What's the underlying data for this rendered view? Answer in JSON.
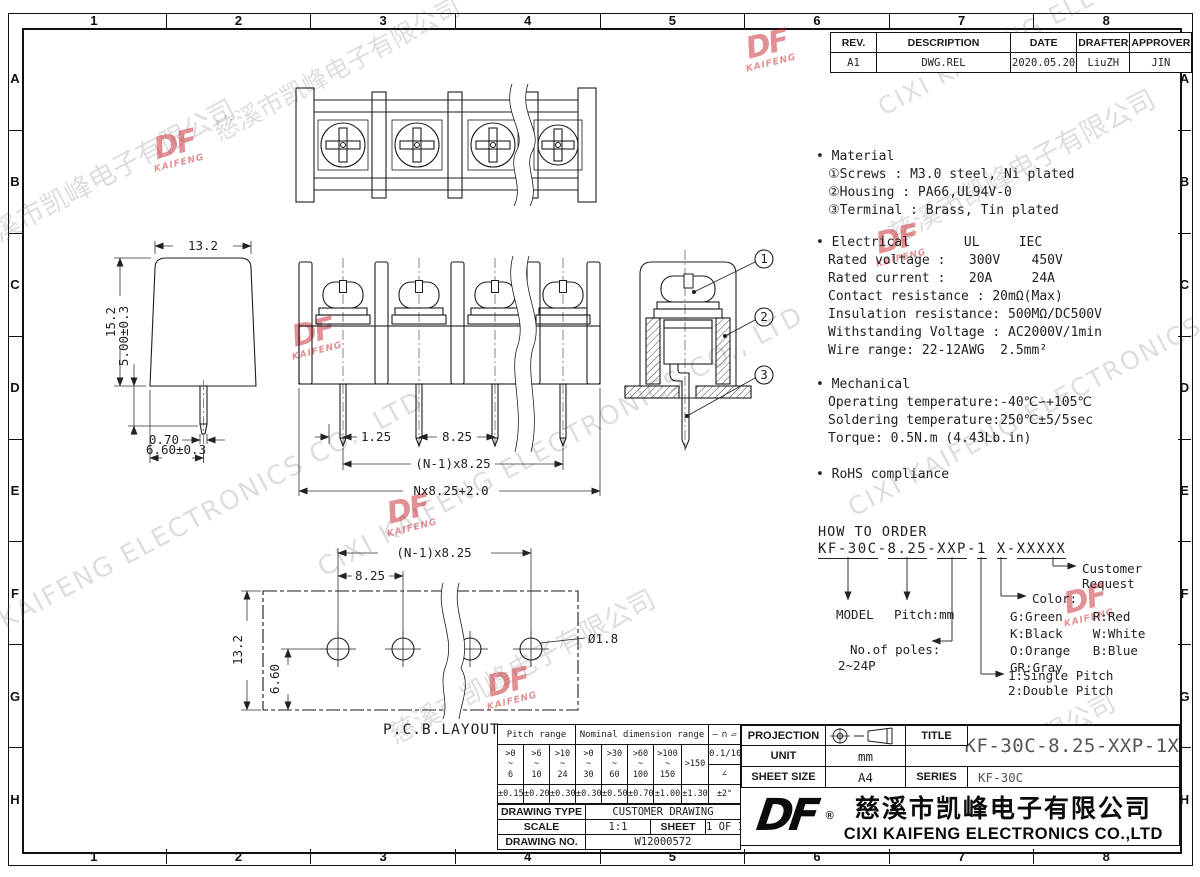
{
  "sheet": {
    "grid_cols": [
      "1",
      "2",
      "3",
      "4",
      "5",
      "6",
      "7",
      "8"
    ],
    "grid_rows": [
      "A",
      "B",
      "C",
      "D",
      "E",
      "F",
      "G",
      "H"
    ]
  },
  "revision_table": {
    "headers": [
      "REV.",
      "DESCRIPTION",
      "DATE",
      "DRAFTER",
      "APPROVER"
    ],
    "row": [
      "A1",
      "DWG.REL",
      "2020.05.20",
      "LiuZH",
      "JIN"
    ]
  },
  "specs": {
    "material": {
      "title": "• Material",
      "lines": [
        "①Screws : M3.0 steel, Ni plated",
        "②Housing : PA66,UL94V-0",
        "③Terminal : Brass, Tin plated"
      ]
    },
    "electrical": {
      "title": "• Electrical",
      "col_headers": "UL     IEC",
      "lines": [
        "Rated voltage :   300V    450V",
        "Rated current :   20A     24A",
        "Contact resistance : 20mΩ(Max)",
        "Insulation resistance: 500MΩ/DC500V",
        "Withstanding Voltage : AC2000V/1min",
        "Wire range: 22-12AWG  2.5mm²"
      ]
    },
    "mechanical": {
      "title": "• Mechanical",
      "lines": [
        "Operating temperature:-40℃∽+105℃",
        "Soldering temperature:250℃±5/5sec",
        "Torque: 0.5N.m (4.43Lb.in)"
      ]
    },
    "rohs": {
      "title": "• RoHS compliance"
    }
  },
  "order": {
    "title": "HOW TO ORDER",
    "segments": [
      "KF-30C",
      "8.25",
      "XXP",
      "1",
      "X",
      "XXXXX"
    ],
    "dashes": [
      "-",
      "-",
      "-",
      " ",
      "-"
    ],
    "labels": {
      "model": "MODEL",
      "pitch": "Pitch:mm",
      "poles": "No.of poles:",
      "poles_range": "2~24P",
      "single": "1:Single Pitch",
      "double": "2:Double Pitch",
      "color": "Color:",
      "color_rows": [
        "G:Green    R:Red",
        "K:Black    W:White",
        "O:Orange   B:Blue",
        "GR:Gray"
      ],
      "customer_line1": "Customer",
      "customer_line2": "Request"
    }
  },
  "dims": {
    "side": {
      "width": "13.2",
      "height": "15.2",
      "pin_len": "5.00±0.3",
      "pin_w": "0.70",
      "pin_off": "6.60±0.3"
    },
    "front": {
      "a": "1.25",
      "b": "8.25",
      "c": "(N-1)x8.25",
      "d": "Nx8.25+2.0"
    },
    "pcb": {
      "a": "(N-1)x8.25",
      "b": "8.25",
      "h": "13.2",
      "v": "6.60",
      "hole": "Ø1.8",
      "caption": "P.C.B.LAYOUT"
    }
  },
  "section_callouts": [
    "1",
    "2",
    "3"
  ],
  "tolerance_table": {
    "pitch_label": "Pitch range",
    "nominal_label": "Nominal dimension range",
    "symbols": [
      "—",
      "∩",
      "▱"
    ],
    "ranges": [
      ">0\n~\n6",
      ">6\n~\n10",
      ">10\n~\n24",
      ">0\n~\n30",
      ">30\n~\n60",
      ">60\n~\n100",
      ">100\n~\n150"
    ],
    "range_over": ">150",
    "angle_num": "0.1/10",
    "angle_sym": "∠",
    "tols": [
      "±0.15",
      "±0.20",
      "±0.30",
      "±0.30",
      "±0.50",
      "±0.70",
      "±1.00",
      "±1.30"
    ],
    "angle_tol": "±2°"
  },
  "info": {
    "drawing_type_label": "DRAWING TYPE",
    "drawing_type": "CUSTOMER DRAWING",
    "scale_label": "SCALE",
    "scale": "1:1",
    "sheet_label": "SHEET",
    "sheet": "1 OF 1",
    "drawing_no_label": "DRAWING NO.",
    "drawing_no": "W12000572"
  },
  "title_block": {
    "projection_label": "PROJECTION",
    "unit_label": "UNIT",
    "unit_value": "mm",
    "sheet_size_label": "SHEET SIZE",
    "sheet_size_value": "A4",
    "title_label": "TITLE",
    "title_value": "KF-30C-8.25-XXP-1X",
    "series_label": "SERIES",
    "series_value": "KF-30C",
    "logo_text": "DF",
    "registered": "®",
    "company_cn": "慈溪市凯峰电子有限公司",
    "company_en": "CIXI KAIFENG ELECTRONICS CO.,LTD"
  },
  "watermark": {
    "cn": "慈溪市凯峰电子有限公司",
    "en": "CIXI KAIFENG ELECTRONICS CO., LTD",
    "logo": "DF",
    "logo_sub": "KAIFENG"
  }
}
